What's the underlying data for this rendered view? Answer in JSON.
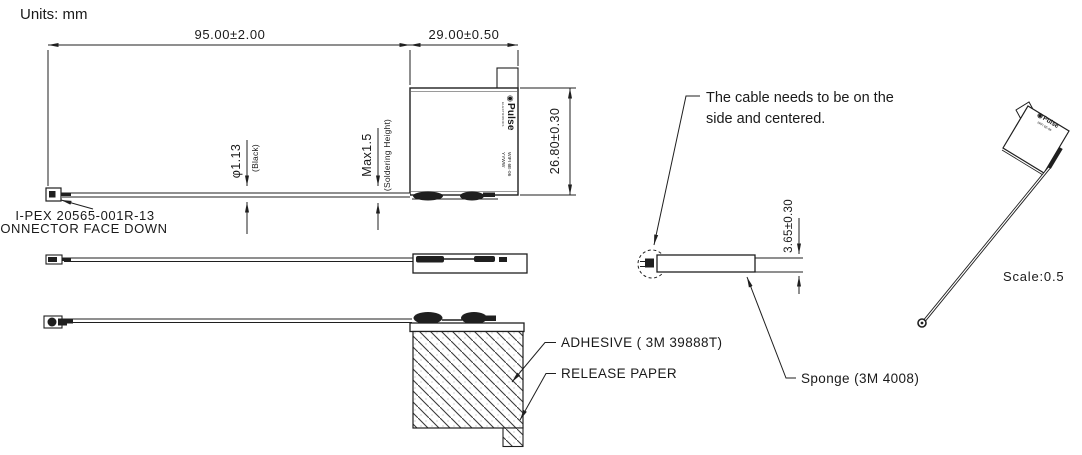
{
  "units_label": "Units: mm",
  "colors": {
    "line": "#1f1f1f",
    "text": "#1a1a1a"
  },
  "top_view": {
    "dim_overall": "95.00±2.00",
    "dim_body_width": "29.00±0.50",
    "dim_body_height": "26.80±0.30",
    "cable_diameter": "φ1.13",
    "cable_diameter_note": "(Black)",
    "solder_height": "Max1.5",
    "solder_height_note": "(Soldering Height)",
    "connector_note_line1": "I-PEX 20565-001R-13",
    "connector_note_line2": "CONNECTOR FACE DOWN"
  },
  "branding": {
    "logo_mark": "◉",
    "logo_name": "Pulse",
    "logo_subtext": "ELECTRONICS",
    "marking_line1": "WIFI 6E-06",
    "marking_line2": "YYWW"
  },
  "cable_detail_view": {
    "note_line1": "The cable needs to be on the",
    "note_line2": "side and centered.",
    "dim_thickness": "3.65±0.30",
    "sponge_label": "Sponge (3M 4008)"
  },
  "bottom_view": {
    "adhesive_label": "ADHESIVE ( 3M 39888T)",
    "release_paper_label": "RELEASE PAPER"
  },
  "iso_view": {
    "scale_label": "Scale:0.5"
  }
}
